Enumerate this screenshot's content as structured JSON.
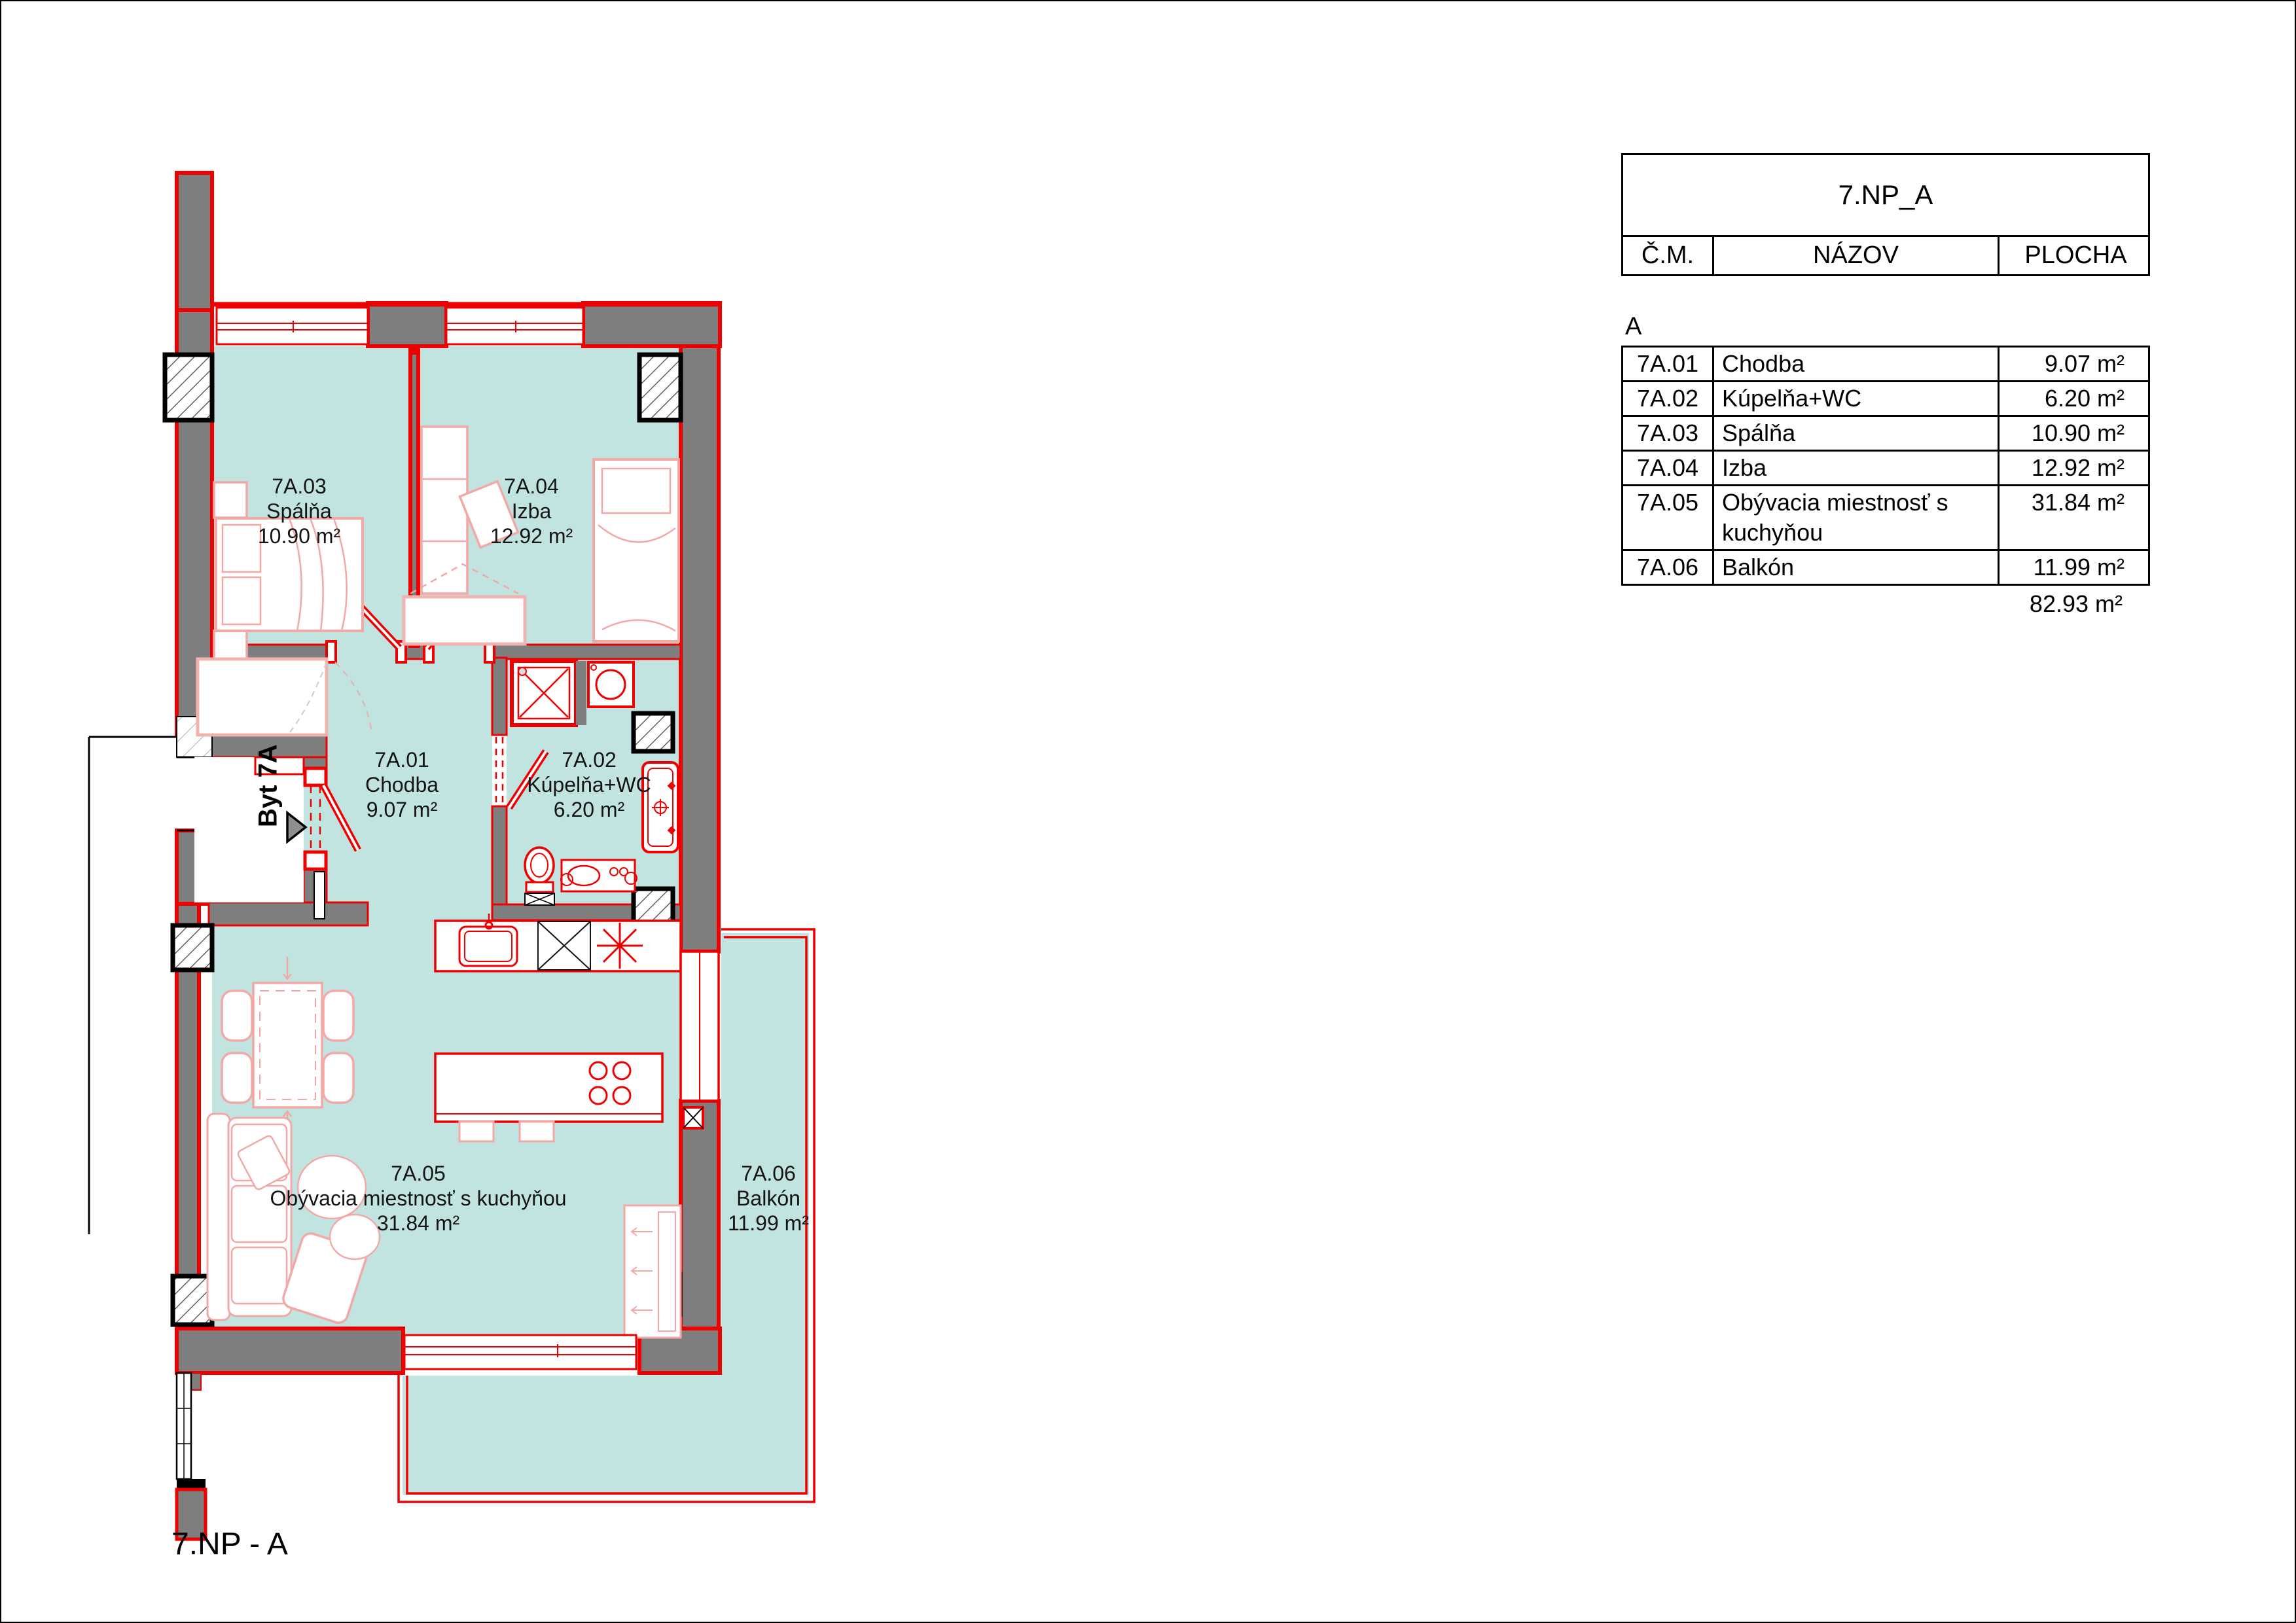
{
  "plan": {
    "entry_label": "Byt 7A",
    "floor_label": "7.NP - A"
  },
  "rooms": [
    {
      "id": "7A.01",
      "name": "Chodba",
      "area": "9.07 m²"
    },
    {
      "id": "7A.02",
      "name": "Kúpelňa+WC",
      "area": "6.20 m²"
    },
    {
      "id": "7A.03",
      "name": "Spálňa",
      "area": "10.90 m²"
    },
    {
      "id": "7A.04",
      "name": "Izba",
      "area": "12.92 m²"
    },
    {
      "id": "7A.05",
      "name": "Obývacia miestnosť s kuchyňou",
      "area": "31.84 m²"
    },
    {
      "id": "7A.06",
      "name": "Balkón",
      "area": "11.99 m²"
    }
  ],
  "legend_table": {
    "title": "7.NP_A",
    "columns": [
      "Č.M.",
      "NÁZOV",
      "PLOCHA"
    ],
    "section_label": "A",
    "total_area": "82.93 m²"
  },
  "colors": {
    "room_fill": "#c2e4e0",
    "wall_fill": "#7e7e7e",
    "line_red": "#ee0000",
    "furniture_pink": "#f2a9a6"
  }
}
